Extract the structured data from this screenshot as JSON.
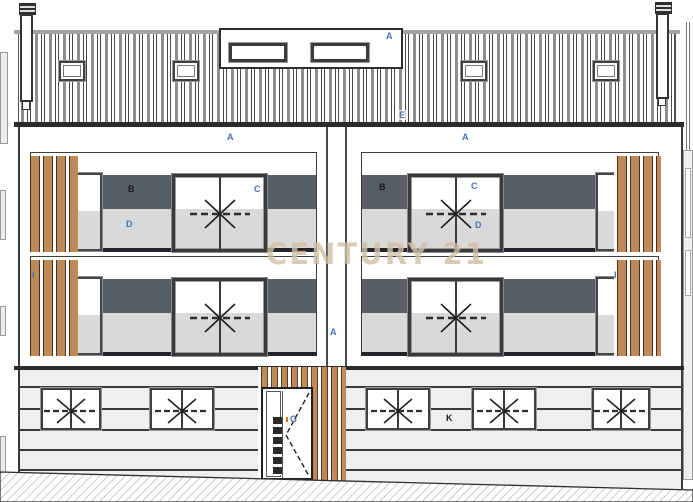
{
  "watermark": {
    "text": "CENTURY 21"
  },
  "annotations": {
    "dormer": "A",
    "roof_eave": "E",
    "upper_wall_left": "A",
    "upper_wall_right": "A",
    "party_wall": "A",
    "balcony_left_wall": "B",
    "balcony_left_door": "C",
    "balcony_left_parapet": "D",
    "balcony_right_wall": "B",
    "balcony_right_door": "C",
    "balcony_right_parapet": "D",
    "slat_screen_left": "I",
    "slat_screen_right": "I",
    "entrance_door": "G",
    "ground_wall": "K"
  },
  "colors": {
    "wood": "#bf8a59",
    "dark_band": "#575e64",
    "light_band": "#d9d9d9",
    "wall_light": "#efefef",
    "line_dark": "#2b2b2b",
    "label_blue": "#4a6fb5",
    "label_dark": "#15181c",
    "watermark": "#cfc0a6"
  }
}
